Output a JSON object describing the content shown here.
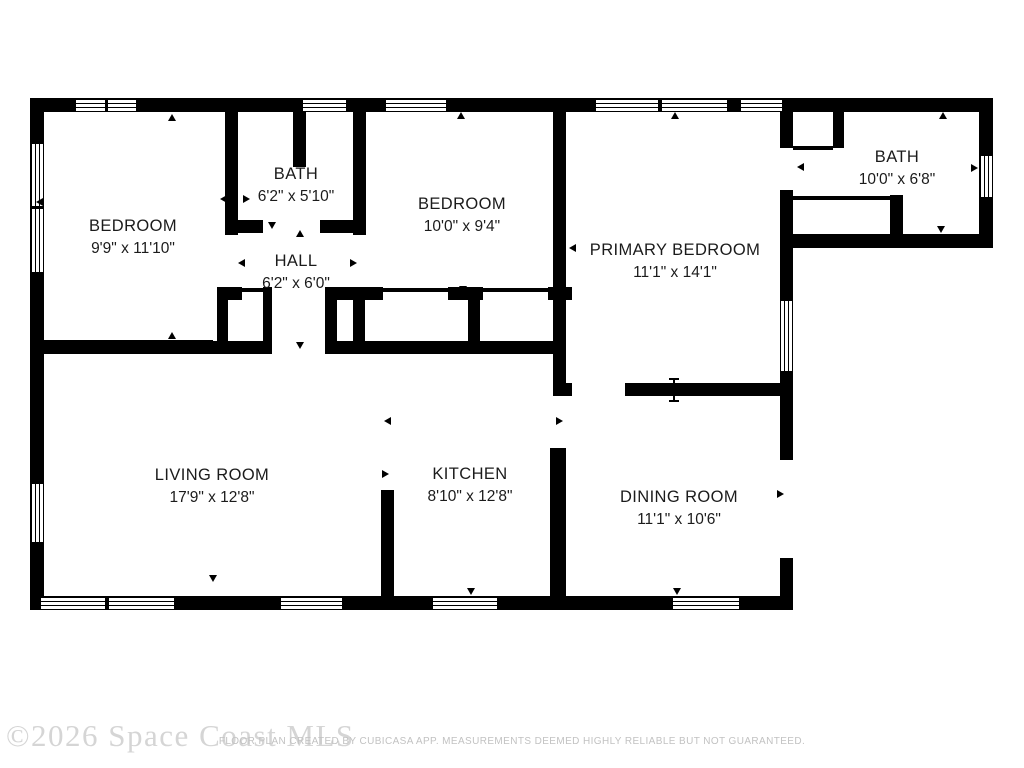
{
  "floor_plan": {
    "rooms": [
      {
        "name": "BEDROOM",
        "dims": "9'9\" x 11'10\""
      },
      {
        "name": "BATH",
        "dims": "6'2\" x 5'10\""
      },
      {
        "name": "HALL",
        "dims": "6'2\" x 6'0\""
      },
      {
        "name": "BEDROOM",
        "dims": "10'0\" x 9'4\""
      },
      {
        "name": "PRIMARY BEDROOM",
        "dims": "11'1\" x 14'1\""
      },
      {
        "name": "BATH",
        "dims": "10'0\" x 6'8\""
      },
      {
        "name": "LIVING ROOM",
        "dims": "17'9\" x 12'8\""
      },
      {
        "name": "KITCHEN",
        "dims": "8'10\" x 12'8\""
      },
      {
        "name": "DINING ROOM",
        "dims": "11'1\" x 10'6\""
      }
    ],
    "watermark": "©2026 Space Coast MLS",
    "disclaimer": "FLOOR PLAN CREATED BY CUBICASA APP. MEASUREMENTS DEEMED HIGHLY RELIABLE BUT NOT GUARANTEED.",
    "colors": {
      "wall": "#000000",
      "background": "#ffffff",
      "label": "#1b1b1b",
      "watermark": "#d5d5d5",
      "disclaimer": "#c2c2c2"
    }
  }
}
